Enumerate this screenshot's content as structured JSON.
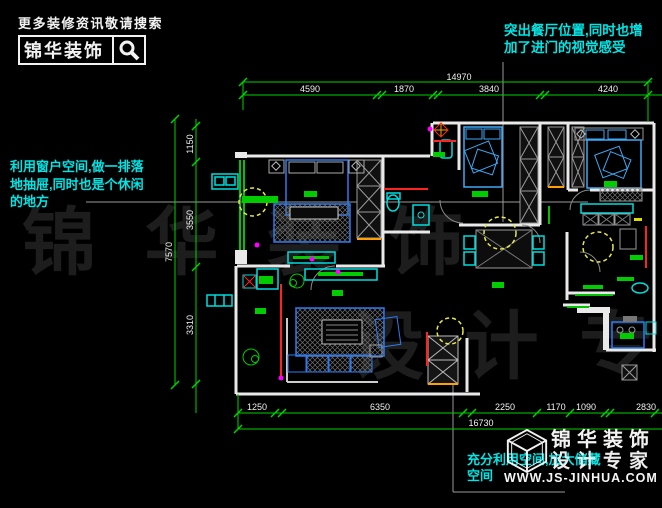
{
  "header": {
    "tagline": "更多装修资讯敬请搜索",
    "brand": "锦华装饰",
    "search_icon": "magnifier-icon"
  },
  "annotations": {
    "dining": {
      "lines": [
        "突出餐厅位置,同时也增",
        "加了进门的视觉感受"
      ]
    },
    "window_seat": {
      "lines": [
        "利用窗户空间,做一排落",
        "地抽屉,同时也是个休闲",
        "的地方"
      ]
    },
    "storage": {
      "lines": [
        "充分利用空间,加大储藏",
        "空间"
      ]
    }
  },
  "dimensions": {
    "top": {
      "total": "14970",
      "segments": [
        "4590",
        "1870",
        "3840",
        "4240"
      ]
    },
    "left": {
      "total": "7570",
      "segments": [
        "1150",
        "3550",
        "3310"
      ]
    },
    "bottom": {
      "total": "16730",
      "segments": [
        "1250",
        "6350",
        "2250",
        "1170",
        "1090",
        "2830"
      ]
    }
  },
  "footer_logo": {
    "brand": "锦华装饰",
    "subtitle": "设计专家",
    "website": "WWW.JS-JINHUA.COM",
    "icon": "wireframe-cube-icon"
  },
  "watermark": {
    "row1": "锦 华 装 饰",
    "row2": "设 计 专 家"
  },
  "colors": {
    "background": "#000000",
    "dimension_green": "#00d400",
    "annotation_cyan": "#00e5e5",
    "wall_white": "#e9e9e9",
    "furniture_blue": "#2e7bf0",
    "furniture_cyan": "#00dddd",
    "highlight_yellow": "#e8e84a",
    "accent_red": "#ff2222",
    "accent_orange": "#ffa200",
    "accent_magenta": "#ff00ff",
    "label_green": "#00cc00",
    "leader_gray": "#9a9a9a",
    "watermark_gray": "#1d1d1d"
  }
}
